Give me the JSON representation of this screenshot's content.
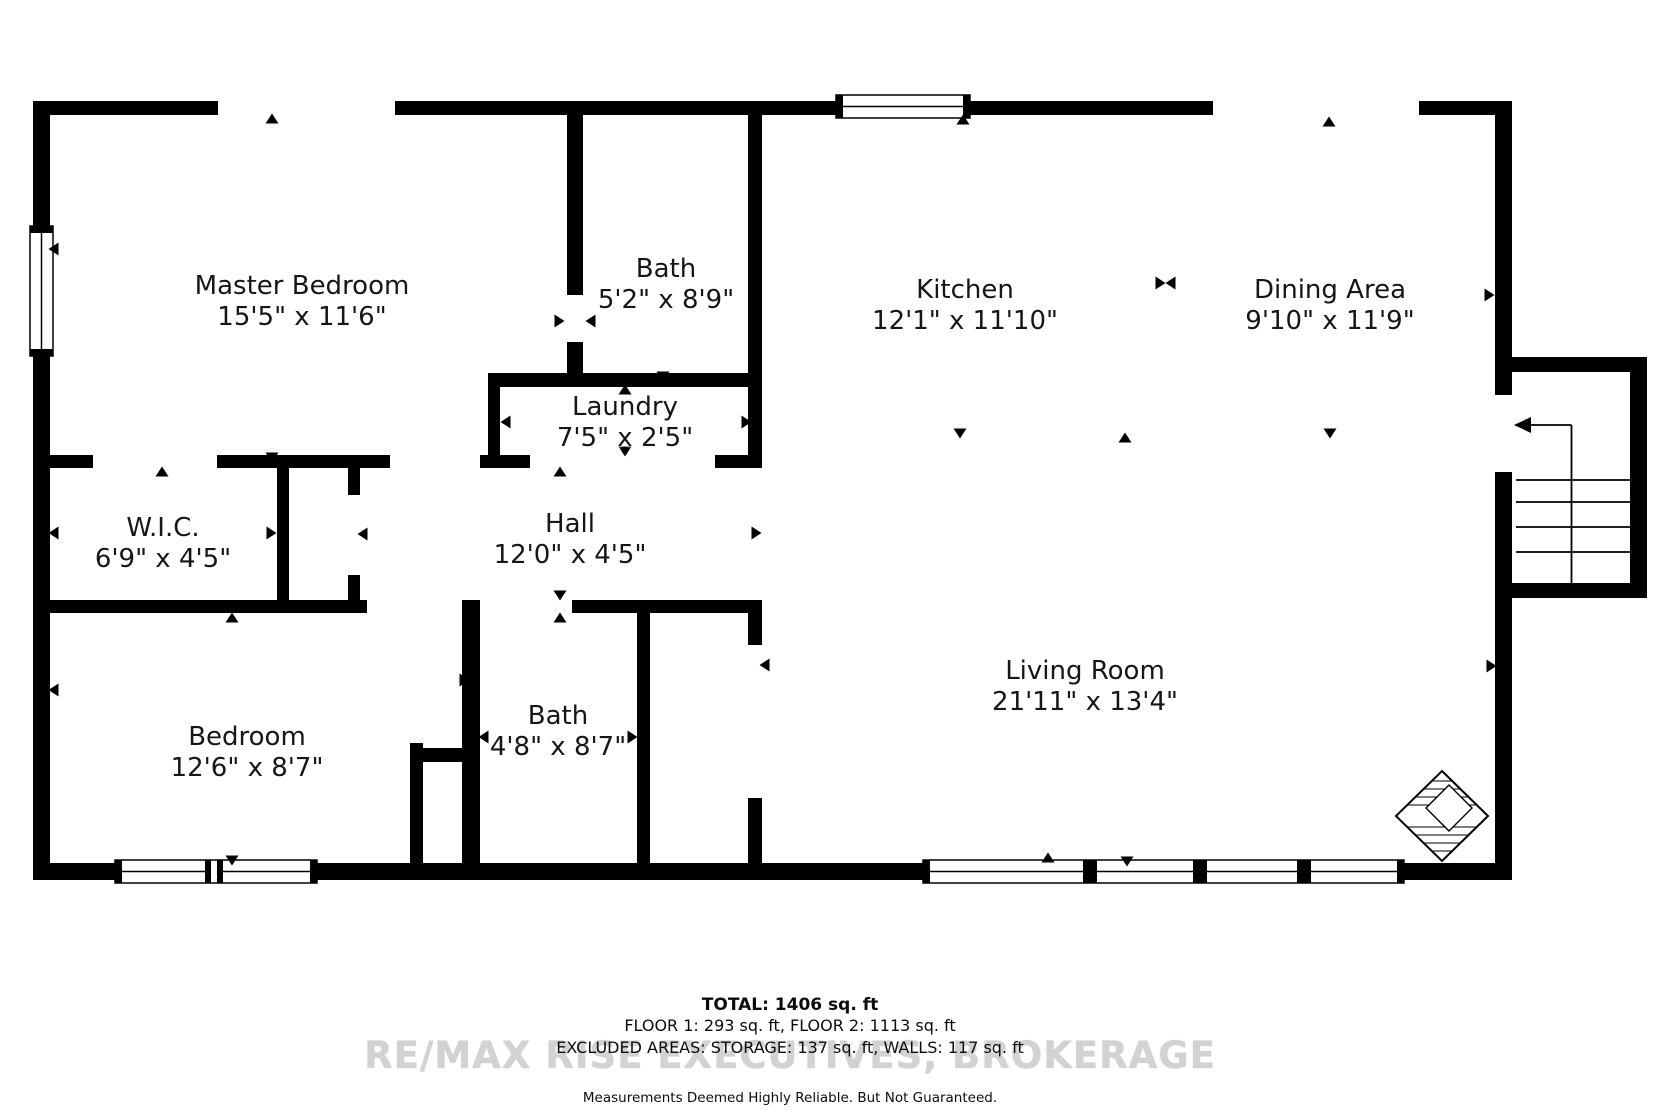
{
  "plan_title": "Floor plan",
  "rooms": [
    {
      "id": "master-bedroom",
      "name": "Master Bedroom",
      "dims": "15'5\" x 11'6\""
    },
    {
      "id": "bath-upper",
      "name": "Bath",
      "dims": "5'2\" x 8'9\""
    },
    {
      "id": "laundry",
      "name": "Laundry",
      "dims": "7'5\" x 2'5\""
    },
    {
      "id": "kitchen",
      "name": "Kitchen",
      "dims": "12'1\" x 11'10\""
    },
    {
      "id": "dining-area",
      "name": "Dining Area",
      "dims": "9'10\" x 11'9\""
    },
    {
      "id": "wic",
      "name": "W.I.C.",
      "dims": "6'9\" x 4'5\""
    },
    {
      "id": "hall",
      "name": "Hall",
      "dims": "12'0\" x 4'5\""
    },
    {
      "id": "bedroom",
      "name": "Bedroom",
      "dims": "12'6\" x 8'7\""
    },
    {
      "id": "bath-lower",
      "name": "Bath",
      "dims": "4'8\" x 8'7\""
    },
    {
      "id": "living-room",
      "name": "Living Room",
      "dims": "21'11\" x 13'4\""
    }
  ],
  "footer": {
    "total": "TOTAL: 1406 sq. ft",
    "floors": "FLOOR 1: 293 sq. ft, FLOOR 2: 1113 sq. ft",
    "excluded": "EXCLUDED AREAS: STORAGE: 137 sq. ft, WALLS: 117 sq. ft",
    "disclaimer": "Measurements Deemed Highly Reliable. But Not Guaranteed."
  },
  "watermark": "RE/MAX RISE EXECUTIVES, BROKERAGE",
  "colors": {
    "wall": "#000000",
    "background": "#ffffff",
    "label": "#161616",
    "watermark": "#d2d2d2"
  }
}
